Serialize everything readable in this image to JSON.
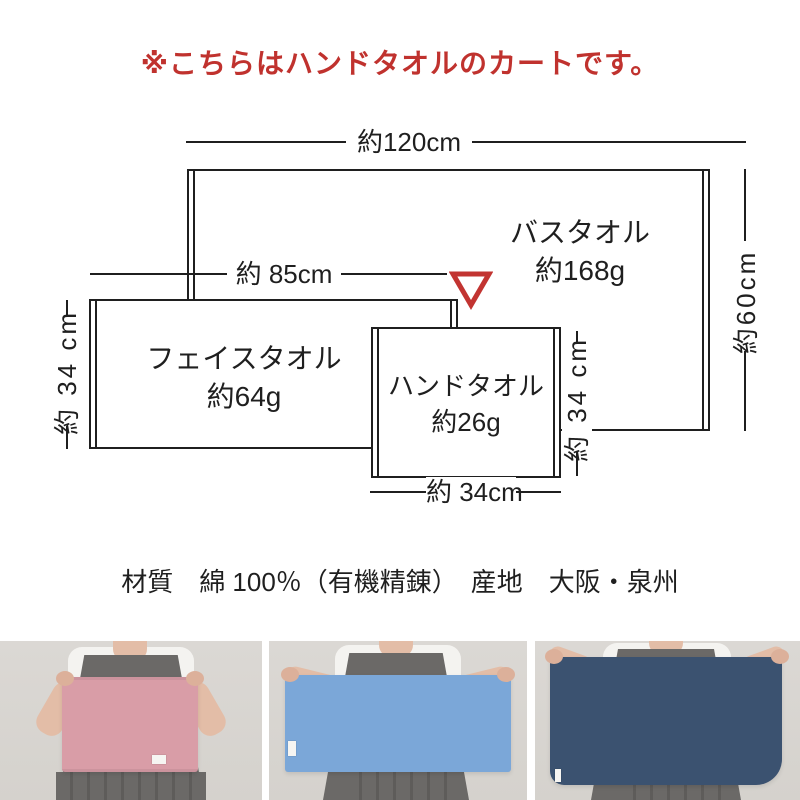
{
  "notice": {
    "text": "※こちらはハンドタオルのカートです。"
  },
  "diagram": {
    "towels": {
      "bath": {
        "name": "バスタオル",
        "weight": "約168g"
      },
      "face": {
        "name": "フェイスタオル",
        "weight": "約64g"
      },
      "hand": {
        "name": "ハンドタオル",
        "weight": "約26g"
      }
    },
    "dims": {
      "bath_width": "約120cm",
      "bath_height": "約60cm",
      "face_width": "約 85cm",
      "face_height": "約 34 cm",
      "hand_width": "約 34cm",
      "hand_height": "約 34 cm"
    },
    "pointer": {
      "shape": "down-triangle-outline"
    }
  },
  "specs": {
    "text": "材質　綿 100％（有機精錬）　産地　大阪・泉州"
  },
  "colors": {
    "notice_red": "#c0322e",
    "pointer_red": "#c23431",
    "line_black": "#1f1f1f",
    "hand_towel_pink": "#d99da7",
    "face_towel_blue": "#7ba7d8",
    "bath_towel_navy": "#3b5270"
  }
}
